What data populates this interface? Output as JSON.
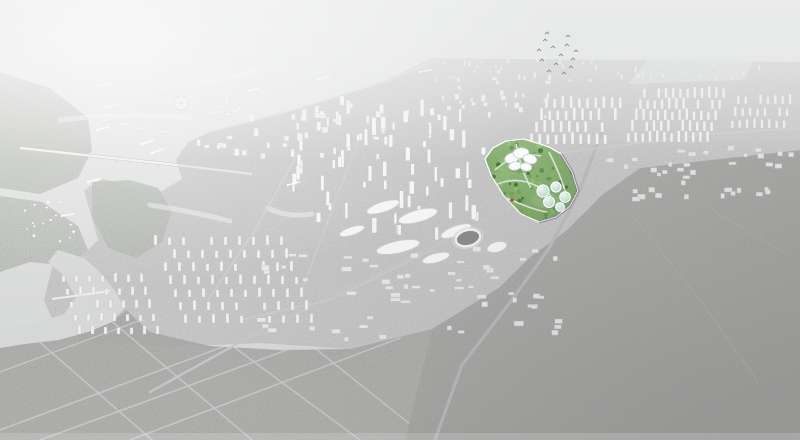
{
  "meta": {
    "kind": "aerial-city-masterplan-rendering",
    "width": 800,
    "height": 440,
    "visible_text": ""
  },
  "palette": {
    "water": "#dcdddd",
    "water_deep": "#d6d7d7",
    "haze": "#eaebeb",
    "glow": "#f4f4f4",
    "city_base": "#c9c9c9",
    "forest_sw": "#b2b2b1",
    "forest_e_top": "#b7b7b6",
    "forest_e_bottom": "#9c9c9b",
    "island": "#c2c5c0",
    "building_fill": "#f5f5f6",
    "building_stroke": "#c2c2c2",
    "road_light": "#d6d6d6",
    "bridge_deck": "#f0f0f0",
    "site_green": "#7fa966",
    "site_green_light": "#9cc286",
    "tree_dark": "#3e6e33",
    "dome_teal": "#9dcfbe",
    "dome_rim": "#ffffff",
    "shell_roof": "#fbfcfc",
    "red_accent": "#b23b30",
    "edge_road": "#7d8287",
    "stadium_inner": "#8a8a8a",
    "bird": "#8f8f8f"
  },
  "scene": {
    "clusters": [
      {
        "name": "distant-towers",
        "mode": "scatter",
        "seed": 7,
        "box": [
          432,
          56,
          360,
          26
        ],
        "count": 60,
        "w": [
          1.2,
          3
        ],
        "h": [
          2,
          6
        ],
        "fill": "#ededed",
        "stroke": "#d2d2d2"
      },
      {
        "name": "north-shore-blocks",
        "mode": "scatter",
        "seed": 71,
        "box": [
          430,
          80,
          120,
          40
        ],
        "count": 26,
        "w": [
          2,
          5
        ],
        "h": [
          3,
          7
        ],
        "fill": "#f0f0f0",
        "stroke": "#c9c9c9"
      },
      {
        "name": "tower-rows-east-a",
        "mode": "grid",
        "x": 545,
        "y": 108,
        "cols": 10,
        "rows": 4,
        "dx": 8.2,
        "dy": 12,
        "off": -5,
        "w": 3,
        "h": 9,
        "hv": 4,
        "seed": 11,
        "fill": "#f4f4f4",
        "stroke": "#c4c4c4"
      },
      {
        "name": "tower-rows-east-b",
        "mode": "grid",
        "x": 643,
        "y": 98,
        "cols": 12,
        "rows": 5,
        "dx": 7.2,
        "dy": 11,
        "off": -4,
        "w": 2.8,
        "h": 8,
        "hv": 4,
        "seed": 12,
        "fill": "#f2f2f2",
        "stroke": "#c6c6c6"
      },
      {
        "name": "tower-rows-east-c",
        "mode": "grid",
        "x": 737,
        "y": 104,
        "cols": 8,
        "rows": 3,
        "dx": 7.4,
        "dy": 12,
        "off": -3,
        "w": 2.6,
        "h": 7,
        "hv": 3,
        "seed": 13,
        "fill": "#efefef",
        "stroke": "#c8c8c8"
      },
      {
        "name": "cbd-towers",
        "mode": "scatter",
        "seed": 21,
        "box": [
          292,
          100,
          190,
          140
        ],
        "count": 72,
        "w": [
          2.5,
          5
        ],
        "h": [
          6,
          18
        ],
        "fill": "#f6f6f6",
        "stroke": "#bfbfbf"
      },
      {
        "name": "waterfront-blocks",
        "mode": "scatter",
        "seed": 31,
        "box": [
          196,
          100,
          190,
          60
        ],
        "count": 42,
        "w": [
          2.5,
          6
        ],
        "h": [
          3,
          8
        ],
        "fill": "#f0f0f0",
        "stroke": "#cacaca"
      },
      {
        "name": "residential-grid-west",
        "mode": "grid",
        "x": 154,
        "y": 245,
        "cols": 10,
        "rows": 7,
        "dx": 14,
        "dy": 13,
        "off": 5,
        "w": 3,
        "h": 7,
        "hv": 3,
        "seed": 41,
        "fill": "#f2f2f2",
        "stroke": "#c6c6c6"
      },
      {
        "name": "residential-grid-southwest",
        "mode": "grid",
        "x": 62,
        "y": 282,
        "cols": 7,
        "rows": 5,
        "dx": 13,
        "dy": 13,
        "off": 4,
        "w": 3,
        "h": 6,
        "hv": 3,
        "seed": 42,
        "fill": "#f0f0f0",
        "stroke": "#c6c6c6"
      },
      {
        "name": "campus-lowrise",
        "mode": "scatter",
        "seed": 51,
        "box": [
          255,
          250,
          300,
          92
        ],
        "count": 58,
        "w": [
          4,
          10
        ],
        "h": [
          2.5,
          5
        ],
        "fill": "#e9e9e9",
        "stroke": "#c9c9c9"
      },
      {
        "name": "east-lowrise",
        "mode": "scatter",
        "seed": 61,
        "box": [
          598,
          150,
          195,
          52
        ],
        "count": 38,
        "w": [
          3,
          8
        ],
        "h": [
          2.5,
          5
        ],
        "fill": "#e3e3e3",
        "stroke": "#c5c5c5"
      }
    ],
    "roads": [
      {
        "name": "coastal-road",
        "pts": [
          [
            214,
            131
          ],
          [
            300,
            108
          ],
          [
            390,
            80
          ],
          [
            432,
            62
          ]
        ],
        "w": 1.5,
        "c": "#d8d8d8",
        "o": 0.9
      },
      {
        "name": "main-boulevard",
        "pts": [
          [
            150,
            392
          ],
          [
            262,
            330
          ],
          [
            420,
            253
          ],
          [
            560,
            182
          ],
          [
            618,
            148
          ]
        ],
        "w": 2.4,
        "c": "#c7c7c7",
        "o": 0.95
      },
      {
        "name": "perimeter-highway",
        "pts": [
          [
            602,
            131
          ],
          [
            578,
            195
          ],
          [
            548,
            250
          ],
          [
            508,
            305
          ],
          [
            462,
            365
          ],
          [
            435,
            440
          ]
        ],
        "w": 3.2,
        "c": "#b9b9b9",
        "o": 0.95
      },
      {
        "name": "city-cross-1",
        "pts": [
          [
            300,
            150
          ],
          [
            255,
            230
          ],
          [
            208,
            300
          ]
        ],
        "w": 1.8,
        "c": "#d0d0d0",
        "o": 0.8
      },
      {
        "name": "city-cross-2",
        "pts": [
          [
            362,
            131
          ],
          [
            332,
            210
          ],
          [
            302,
            290
          ]
        ],
        "w": 1.5,
        "c": "#d0d0d0",
        "o": 0.7
      },
      {
        "name": "city-cross-3",
        "pts": [
          [
            432,
            250
          ],
          [
            330,
            300
          ],
          [
            240,
            320
          ]
        ],
        "w": 1.5,
        "c": "#d0d0d0",
        "o": 0.7
      },
      {
        "name": "avenue-east",
        "pts": [
          [
            545,
            155
          ],
          [
            700,
            135
          ],
          [
            798,
            128
          ]
        ],
        "w": 1.6,
        "c": "#cfcfcf",
        "o": 0.65
      },
      {
        "name": "forest-road-a1",
        "pts": [
          [
            0,
            430
          ],
          [
            300,
            318
          ]
        ],
        "w": 1.6,
        "c": "#cacaca",
        "o": 0.85,
        "clip": "forest"
      },
      {
        "name": "forest-road-a2",
        "pts": [
          [
            40,
            440
          ],
          [
            336,
            332
          ]
        ],
        "w": 1.6,
        "c": "#cacaca",
        "o": 0.85,
        "clip": "forest"
      },
      {
        "name": "forest-road-a3",
        "pts": [
          [
            130,
            440
          ],
          [
            400,
            338
          ]
        ],
        "w": 1.6,
        "c": "#cacaca",
        "o": 0.85,
        "clip": "forest"
      },
      {
        "name": "forest-road-a4",
        "pts": [
          [
            0,
            372
          ],
          [
            190,
            302
          ]
        ],
        "w": 1.4,
        "c": "#cacaca",
        "o": 0.8,
        "clip": "forest"
      },
      {
        "name": "forest-road-b1",
        "pts": [
          [
            12,
            318
          ],
          [
            152,
            440
          ]
        ],
        "w": 1.6,
        "c": "#cacaca",
        "o": 0.85,
        "clip": "forest"
      },
      {
        "name": "forest-road-b2",
        "pts": [
          [
            96,
            308
          ],
          [
            252,
            440
          ]
        ],
        "w": 1.6,
        "c": "#cacaca",
        "o": 0.85,
        "clip": "forest"
      },
      {
        "name": "forest-road-b3",
        "pts": [
          [
            192,
            316
          ],
          [
            360,
            440
          ]
        ],
        "w": 1.6,
        "c": "#cacaca",
        "o": 0.85,
        "clip": "forest"
      },
      {
        "name": "forest-road-b4",
        "pts": [
          [
            292,
            330
          ],
          [
            430,
            440
          ]
        ],
        "w": 1.6,
        "c": "#cacaca",
        "o": 0.85,
        "clip": "forest"
      },
      {
        "name": "east-track-1",
        "pts": [
          [
            620,
            200
          ],
          [
            700,
            300
          ],
          [
            758,
            382
          ]
        ],
        "w": 1.4,
        "c": "#b0b0b0",
        "o": 0.5
      },
      {
        "name": "east-track-2",
        "pts": [
          [
            652,
            172
          ],
          [
            782,
            252
          ]
        ],
        "w": 1.2,
        "c": "#b0b0b0",
        "o": 0.5
      }
    ],
    "bridge": {
      "main": [
        [
          20,
          148
        ],
        [
          177,
          165
        ]
      ],
      "ext": [
        [
          177,
          165
        ],
        [
          252,
          174
        ]
      ],
      "second": [
        [
          52,
          299
        ],
        [
          110,
          291
        ]
      ]
    },
    "marina": [
      [
        100,
        120,
        16,
        3,
        -12
      ],
      [
        118,
        124,
        14,
        3,
        -12
      ],
      [
        136,
        128,
        13,
        3,
        -12
      ],
      [
        160,
        131,
        12,
        3,
        -12
      ],
      [
        206,
        113,
        18,
        3,
        -10
      ],
      [
        230,
        110,
        14,
        3,
        -10
      ]
    ],
    "boats": [
      [
        100,
        86,
        -15
      ],
      [
        106,
        108,
        -18
      ],
      [
        97,
        130,
        -15
      ],
      [
        142,
        144,
        -20
      ],
      [
        152,
        153,
        -20
      ],
      [
        88,
        182,
        -15
      ],
      [
        288,
        185,
        -15
      ],
      [
        318,
        79,
        -12
      ],
      [
        62,
        216,
        -10
      ],
      [
        248,
        91,
        -15
      ],
      [
        420,
        72,
        -10
      ]
    ],
    "sailboats": {
      "box": [
        20,
        200,
        54,
        42
      ],
      "count": 16,
      "seed": 81
    },
    "birds": [
      [
        545,
        40
      ],
      [
        553,
        47
      ],
      [
        561,
        55
      ],
      [
        542,
        60
      ],
      [
        556,
        64
      ],
      [
        567,
        45
      ],
      [
        573,
        59
      ],
      [
        549,
        71
      ],
      [
        564,
        73
      ],
      [
        576,
        51
      ],
      [
        539,
        50
      ],
      [
        571,
        67
      ],
      [
        547,
        33
      ],
      [
        568,
        36
      ]
    ],
    "streaks": [
      "M60,120 q60,-8 130,-2",
      "M150,205 q40,6 80,16",
      "M255,70 q-40,14 -92,17",
      "M268,208 q20,10 44,6"
    ],
    "blobs": [
      [
        383,
        207,
        17,
        5,
        -18
      ],
      [
        418,
        216,
        20,
        6,
        -15
      ],
      [
        456,
        231,
        16,
        5,
        -20
      ],
      [
        398,
        247,
        22,
        6,
        -12
      ],
      [
        352,
        231,
        13,
        4,
        -18
      ],
      [
        436,
        258,
        14,
        4.5,
        -15
      ],
      [
        497,
        247,
        10,
        5,
        -15
      ]
    ],
    "stadium": {
      "cx": 468,
      "cy": 238,
      "rx": 12.5,
      "ry": 8,
      "rot": -15
    },
    "ferris": {
      "cx": 181,
      "cy": 103,
      "r": 7
    },
    "airfield": "648,60 756,55 744,80 628,84",
    "site": {
      "outline": "506,141 524,139 549,147 561,154 572,172 578,191 570,206 556,217 539,222 521,214 504,196 491,175 485,159 493,148",
      "edge_road": "M561,154 L572,172 L578,191 L570,206 L556,217 L539,222",
      "patches": [
        [
          515,
          165,
          18,
          10
        ],
        [
          545,
          200,
          14,
          8
        ],
        [
          500,
          178,
          10,
          6
        ]
      ],
      "paths": [
        "M495,170 C508,158 524,152 541,156",
        "M498,184 C516,176 536,182 551,196",
        "M516,144 C519,158 522,172 531,188",
        "M507,198 C520,204 534,210 547,212",
        "M549,152 C556,166 562,180 566,194"
      ],
      "trees": {
        "box": [
          484,
          138,
          96,
          86
        ],
        "count": 120,
        "r": [
          1,
          2.6
        ],
        "seed": 91,
        "colors": [
          "#3e6e33",
          "#54904a",
          "#69a552",
          "#7fb866",
          "#8fc276"
        ]
      },
      "petals": [
        [
          512,
          158,
          7.5,
          5,
          -18
        ],
        [
          521,
          153,
          8,
          5.2,
          -5
        ],
        [
          530,
          159,
          7,
          4.8,
          15
        ],
        [
          515,
          166,
          6.5,
          4.2,
          -10
        ],
        [
          526,
          167,
          6,
          4,
          10
        ]
      ],
      "domes": [
        [
          543,
          191,
          6
        ],
        [
          556,
          187,
          5
        ],
        [
          565,
          197,
          5.2
        ],
        [
          549,
          202,
          5.4
        ],
        [
          560,
          207,
          4.4
        ]
      ],
      "red": [
        512,
        200,
        1.6
      ]
    }
  }
}
